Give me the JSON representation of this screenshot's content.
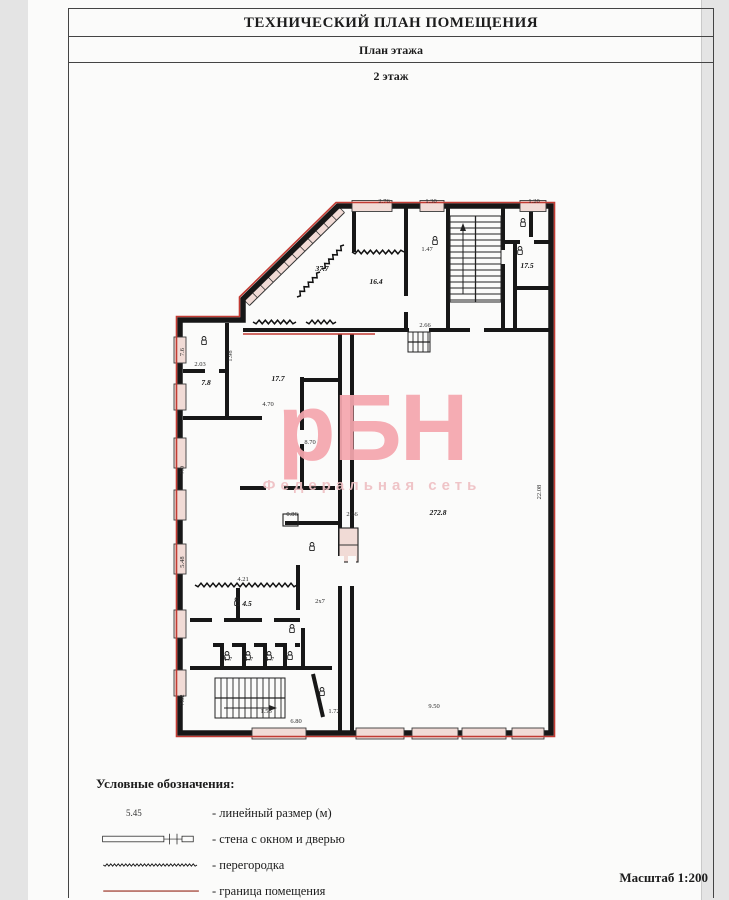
{
  "header": {
    "title": "ТЕХНИЧЕСКИЙ ПЛАН ПОМЕЩЕНИЯ",
    "subtitle": "План этажа",
    "floor_label": "2 этаж"
  },
  "watermark": {
    "text": "рБН",
    "subtext": "Федеральная сеть"
  },
  "legend": {
    "heading": "Условные обозначения:",
    "items": [
      {
        "symbol": "linear-dimension",
        "sample": "5.45",
        "label": "- линейный размер (м)"
      },
      {
        "symbol": "wall-window-door",
        "label": "- стена с окном и дверью"
      },
      {
        "symbol": "partition",
        "label": "- перегородка"
      },
      {
        "symbol": "boundary",
        "label": "- граница помещения"
      }
    ]
  },
  "scale_note": "Масштаб 1:200",
  "theme": {
    "wall": "#171717",
    "boundary": "#c23b33",
    "boundary_legend": "#b4695e",
    "window_fill": "#f1dbd6",
    "watermark": "#f5a7ae",
    "watermark_sub": "#efc0c4"
  },
  "plan": {
    "room_labels": [
      {
        "text": "37.7",
        "x": 322,
        "y": 271
      },
      {
        "text": "16.4",
        "x": 376,
        "y": 284
      },
      {
        "text": "17.5",
        "x": 527,
        "y": 268
      },
      {
        "text": "17.7",
        "x": 278,
        "y": 381
      },
      {
        "text": "7.8",
        "x": 206,
        "y": 385
      },
      {
        "text": "272.8",
        "x": 438,
        "y": 515,
        "size": 8
      },
      {
        "text": "4.5",
        "x": 247,
        "y": 606
      }
    ],
    "dimension_labels": [
      {
        "text": "2.76",
        "x": 384,
        "y": 203
      },
      {
        "text": "1.30",
        "x": 431,
        "y": 203
      },
      {
        "text": "1.20",
        "x": 534,
        "y": 203
      },
      {
        "text": "1.47",
        "x": 427,
        "y": 251
      },
      {
        "text": "2.66",
        "x": 425,
        "y": 327
      },
      {
        "text": "7.6",
        "x": 184,
        "y": 352,
        "rot": -90
      },
      {
        "text": "2.03",
        "x": 200,
        "y": 366
      },
      {
        "text": "1.98",
        "x": 232,
        "y": 356,
        "rot": -90
      },
      {
        "text": "7.0",
        "x": 184,
        "y": 470,
        "rot": -90
      },
      {
        "text": "5.48",
        "x": 184,
        "y": 562,
        "rot": -90
      },
      {
        "text": "7.02",
        "x": 184,
        "y": 700,
        "rot": -90
      },
      {
        "text": "4.70",
        "x": 268,
        "y": 406
      },
      {
        "text": "8.70",
        "x": 310,
        "y": 444
      },
      {
        "text": "0.86",
        "x": 292,
        "y": 516
      },
      {
        "text": "2.66",
        "x": 352,
        "y": 516
      },
      {
        "text": "4.21",
        "x": 243,
        "y": 581
      },
      {
        "text": "2х7",
        "x": 320,
        "y": 603
      },
      {
        "text": "1.7",
        "x": 228,
        "y": 661
      },
      {
        "text": "1.7",
        "x": 249,
        "y": 661
      },
      {
        "text": "1.7",
        "x": 270,
        "y": 661
      },
      {
        "text": "1.56",
        "x": 266,
        "y": 713
      },
      {
        "text": "1.72",
        "x": 334,
        "y": 713
      },
      {
        "text": "6.80",
        "x": 296,
        "y": 723
      },
      {
        "text": "22.08",
        "x": 541,
        "y": 492,
        "rot": -90
      },
      {
        "text": "9.50",
        "x": 434,
        "y": 708
      }
    ]
  }
}
